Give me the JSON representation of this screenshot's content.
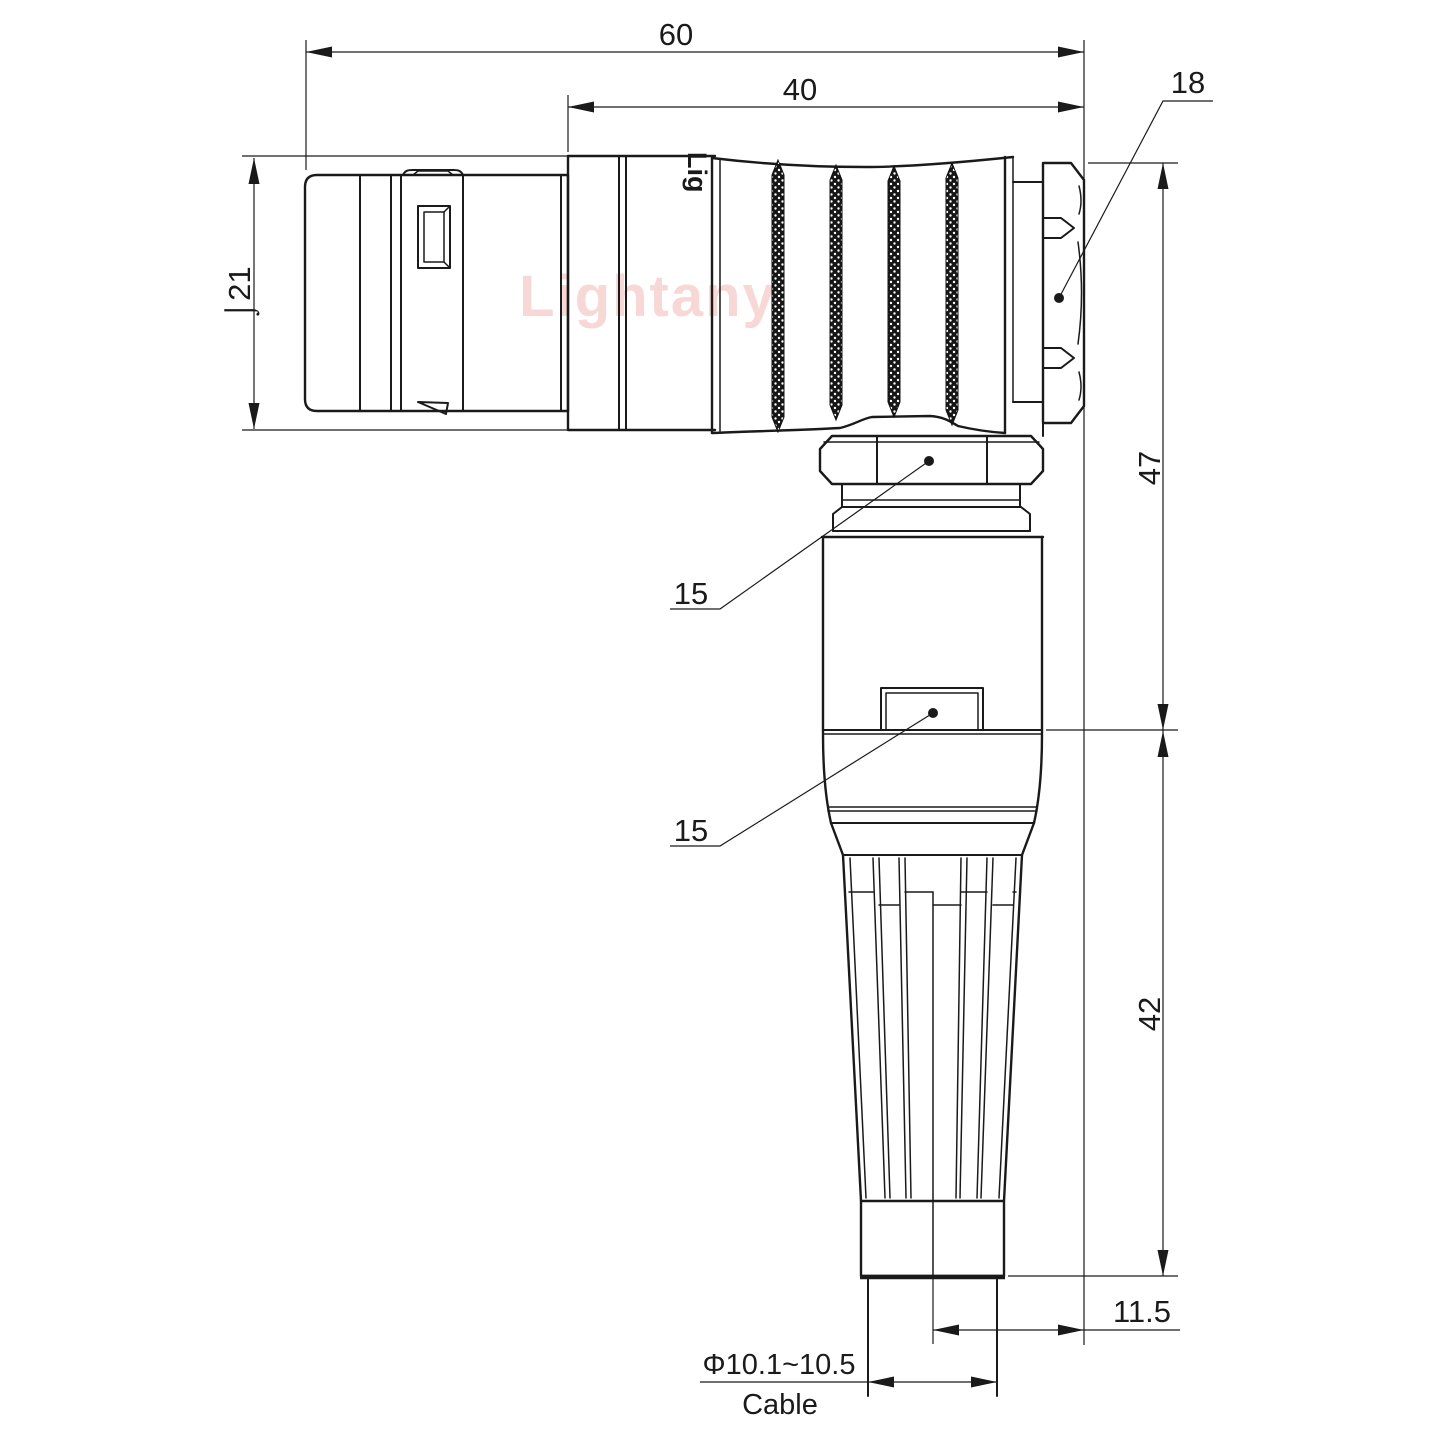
{
  "watermark": {
    "text": "Lightany"
  },
  "engraving": {
    "text": "Lig"
  },
  "colors": {
    "line": "#1a1a1a",
    "watermark": "#f8d7d7",
    "background": "#ffffff"
  },
  "dimensions": {
    "overall_length": "60",
    "body_length": "40",
    "hex_nut_size": "18",
    "front_diameter": "⌡21",
    "upper_height": "47",
    "lower_height": "42",
    "gland_nut_label": "15",
    "boss_label": "15",
    "cable_axis_offset": "11.5",
    "cable_diameter": "Φ10.1~10.5",
    "cable_caption": "Cable"
  }
}
